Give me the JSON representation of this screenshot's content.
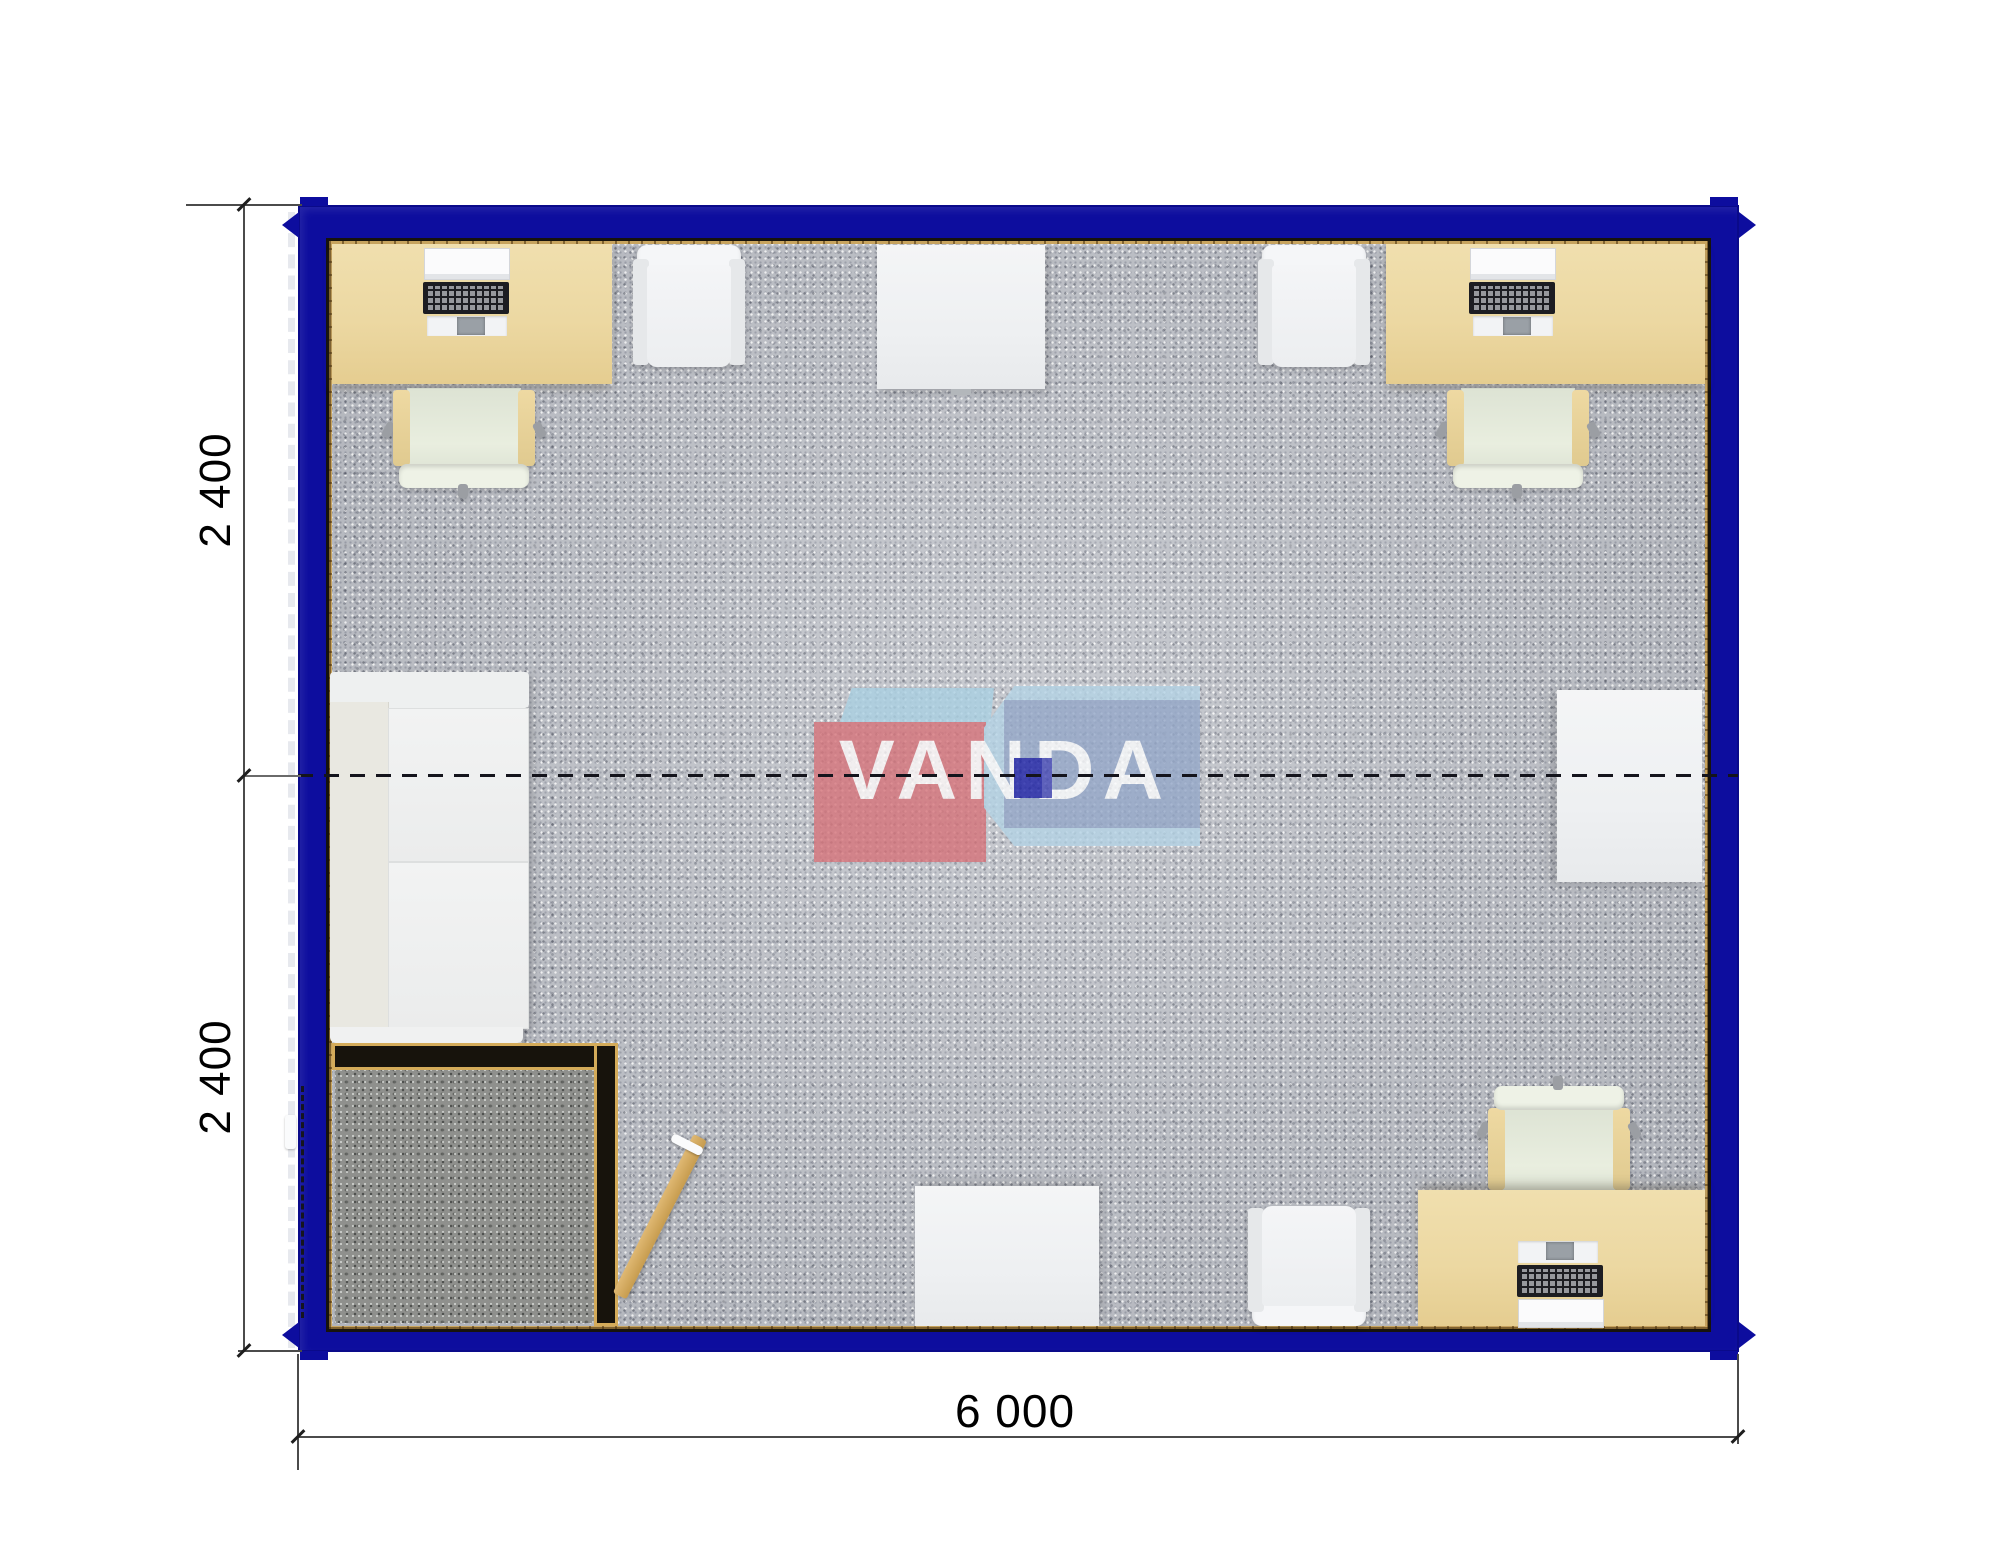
{
  "document": {
    "type": "floor-plan",
    "description": "Top view floor plan of a 6000 x 4800 modular container office (two 2400 modules) with workstations, sofa, tables and entrance vestibule"
  },
  "dimensions": {
    "left_module_top": "2 400",
    "left_module_bottom": "2 400",
    "bottom_total": "6 000"
  },
  "watermark": {
    "text": "VANDA"
  },
  "colors": {
    "frame_blue": "#0d0d9e",
    "carpet_gray": "#bcbfc6",
    "entrance_carpet_dark": "#8f908d",
    "desk_beige": "#ecd8a2",
    "wall_trim_gold": "#c9a55f",
    "partition_black": "#17130c",
    "chair_seat_green": "#e3e9da",
    "white_furniture": "#f1f2f4",
    "door_wood": "#d2a860",
    "logo_red": "#d6737a",
    "logo_light_blue": "#b4d3e5",
    "logo_mid_blue": "#94a7c8",
    "logo_dark_blue_square": "#1c20a6",
    "dimension_line": "#4b4b4b"
  },
  "furniture": [
    "office-desk-top-left",
    "office-chair-top-left",
    "visitor-chair-top-left",
    "table-top-center",
    "visitor-chair-top-right",
    "office-desk-top-right",
    "office-chair-top-right",
    "sofa-left-wall",
    "entrance-vestibule",
    "entrance-door-open",
    "cabinet-right-wall",
    "office-desk-bottom-right",
    "office-chair-bottom-right",
    "table-bottom-center",
    "visitor-chair-bottom"
  ]
}
